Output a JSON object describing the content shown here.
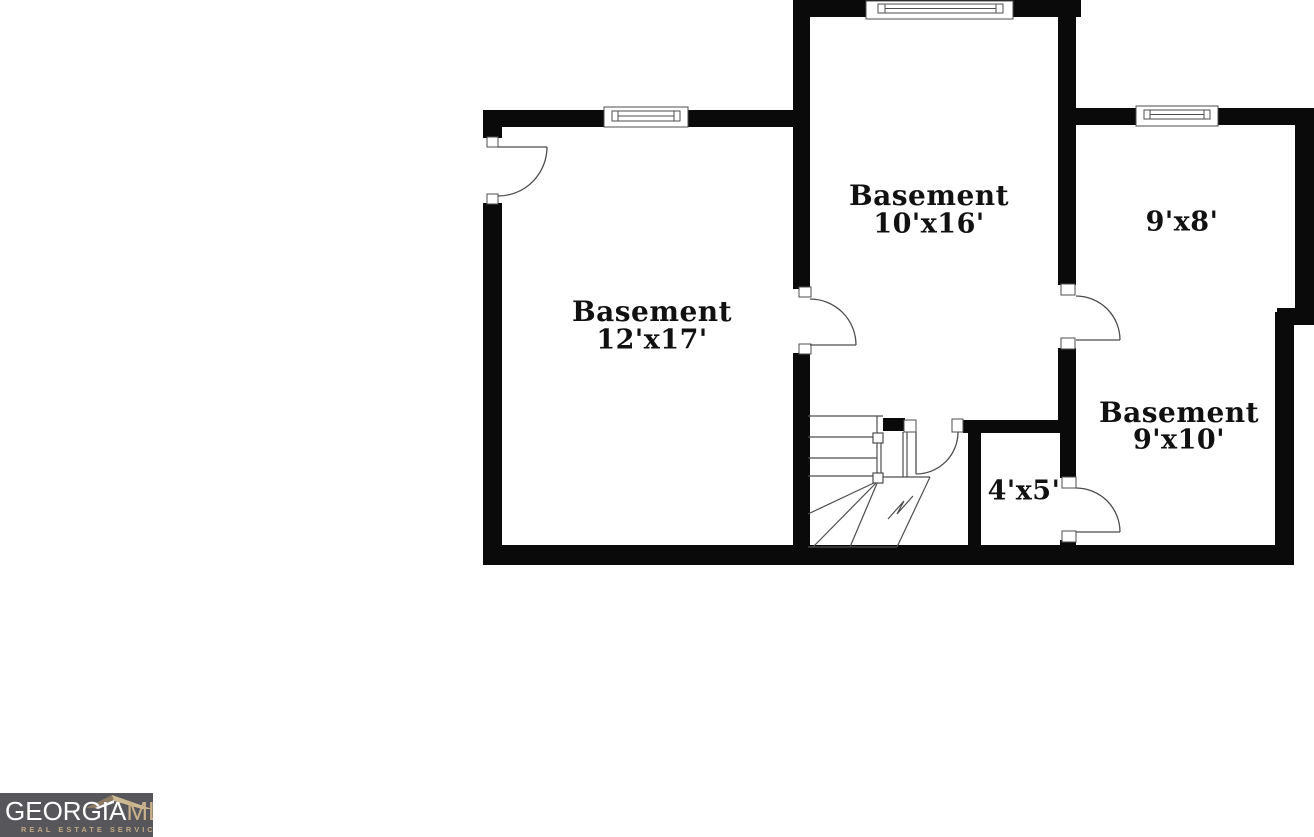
{
  "plan": {
    "wall_color": "#0a0a0a",
    "line_color": "#4d4d4d",
    "rooms": {
      "left": {
        "name": "Basement",
        "dims": "12'x17'"
      },
      "middle": {
        "name": "Basement",
        "dims": "10'x16'"
      },
      "top_right": {
        "dims": "9'x8'"
      },
      "bottom_right": {
        "name": "Basement",
        "dims": "9'x10'"
      },
      "closet": {
        "dims": "4'x5'"
      }
    }
  },
  "logo": {
    "brand_part1": "GEORGIA",
    "brand_part2": "MLS",
    "tagline": "REAL ESTATE SERVICES",
    "colors": {
      "background": "#57565a",
      "primary_text": "#ffffff",
      "accent": "#c9b28c",
      "roof_dark": "#8c7a62",
      "roof_light": "#cdb993"
    }
  }
}
